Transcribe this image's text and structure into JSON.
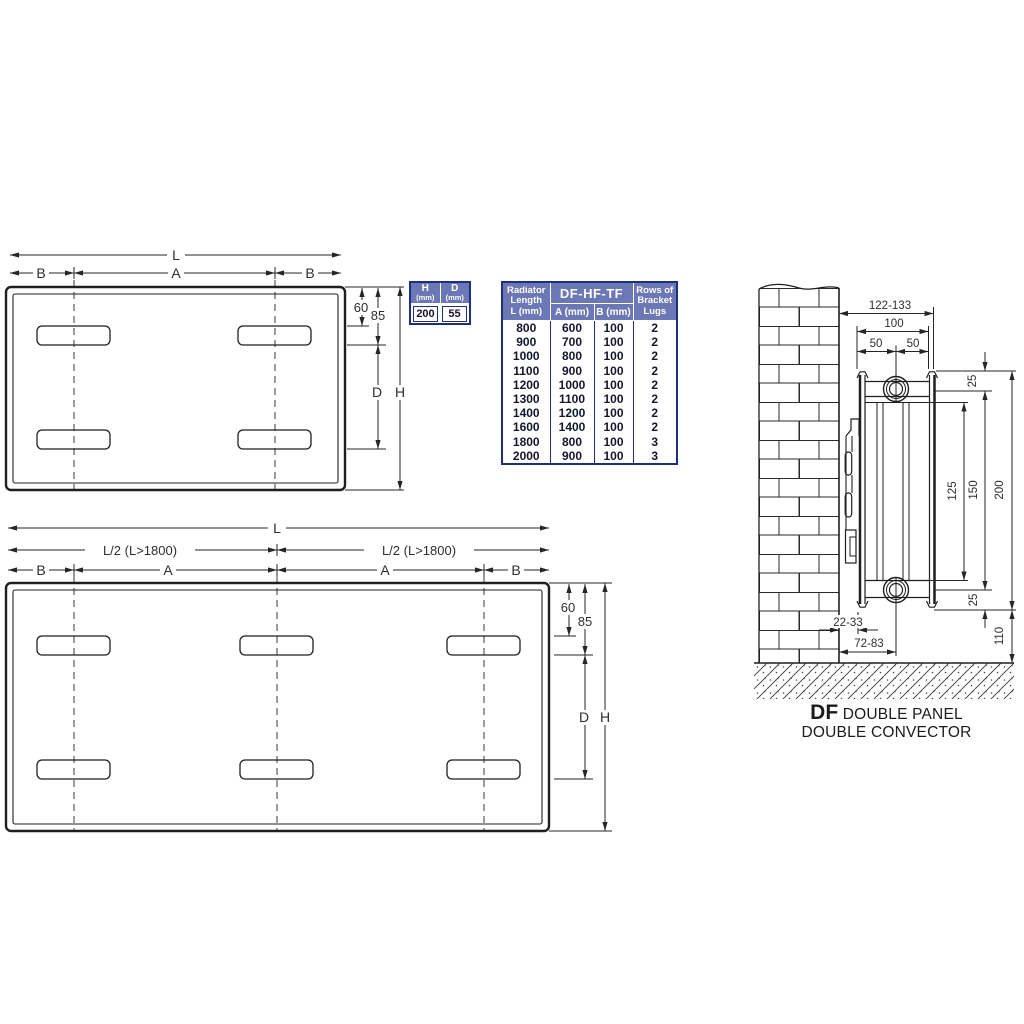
{
  "top_view": {
    "L": "L",
    "B_left": "B",
    "A": "A",
    "B_right": "B",
    "d60": "60",
    "d85": "85",
    "D": "D",
    "H": "H"
  },
  "bottom_view": {
    "L": "L",
    "L2_left": "L/2 (L>1800)",
    "L2_right": "L/2 (L>1800)",
    "B_left": "B",
    "A_left": "A",
    "A_right": "A",
    "B_right": "B",
    "d60": "60",
    "d85": "85",
    "D": "D",
    "H": "H"
  },
  "hd_table": {
    "h_label": "H",
    "h_unit": "(mm)",
    "d_label": "D",
    "d_unit": "(mm)",
    "h_value": "200",
    "d_value": "55"
  },
  "spec_table": {
    "col_length_l1": "Radiator",
    "col_length_l2": "Length",
    "col_length_l3": "L (mm)",
    "group": "DF-HF-TF",
    "col_a": "A (mm)",
    "col_b": "B (mm)",
    "col_lugs_l1": "Rows of",
    "col_lugs_l2": "Bracket",
    "col_lugs_l3": "Lugs",
    "rows": [
      {
        "l": "800",
        "a": "600",
        "b": "100",
        "lugs": "2"
      },
      {
        "l": "900",
        "a": "700",
        "b": "100",
        "lugs": "2"
      },
      {
        "l": "1000",
        "a": "800",
        "b": "100",
        "lugs": "2"
      },
      {
        "l": "1100",
        "a": "900",
        "b": "100",
        "lugs": "2"
      },
      {
        "l": "1200",
        "a": "1000",
        "b": "100",
        "lugs": "2"
      },
      {
        "l": "1300",
        "a": "1100",
        "b": "100",
        "lugs": "2"
      },
      {
        "l": "1400",
        "a": "1200",
        "b": "100",
        "lugs": "2"
      },
      {
        "l": "1600",
        "a": "1400",
        "b": "100",
        "lugs": "2"
      },
      {
        "l": "1800",
        "a": "800",
        "b": "100",
        "lugs": "3"
      },
      {
        "l": "2000",
        "a": "900",
        "b": "100",
        "lugs": "3"
      }
    ]
  },
  "wall_view": {
    "wall_to_front": "122-133",
    "panel_spread": "100",
    "half_left": "50",
    "half_right": "50",
    "top_25": "25",
    "mid_150": "150",
    "inner_125": "125",
    "height_200": "200",
    "bottom_25": "25",
    "floor_110": "110",
    "wall_gap": "22-33",
    "wall_to_pipe": "72-83"
  },
  "caption": {
    "code": "DF",
    "title_rest": "DOUBLE PANEL",
    "title_line2": "DOUBLE CONVECTOR"
  },
  "colors": {
    "line": "#262626",
    "drawing": "#1f1f1f",
    "table_border": "#1e2f7e",
    "table_header_bg": "#6c77b5",
    "table_header_text": "#ffffff",
    "table_cell_text": "#15152e"
  }
}
